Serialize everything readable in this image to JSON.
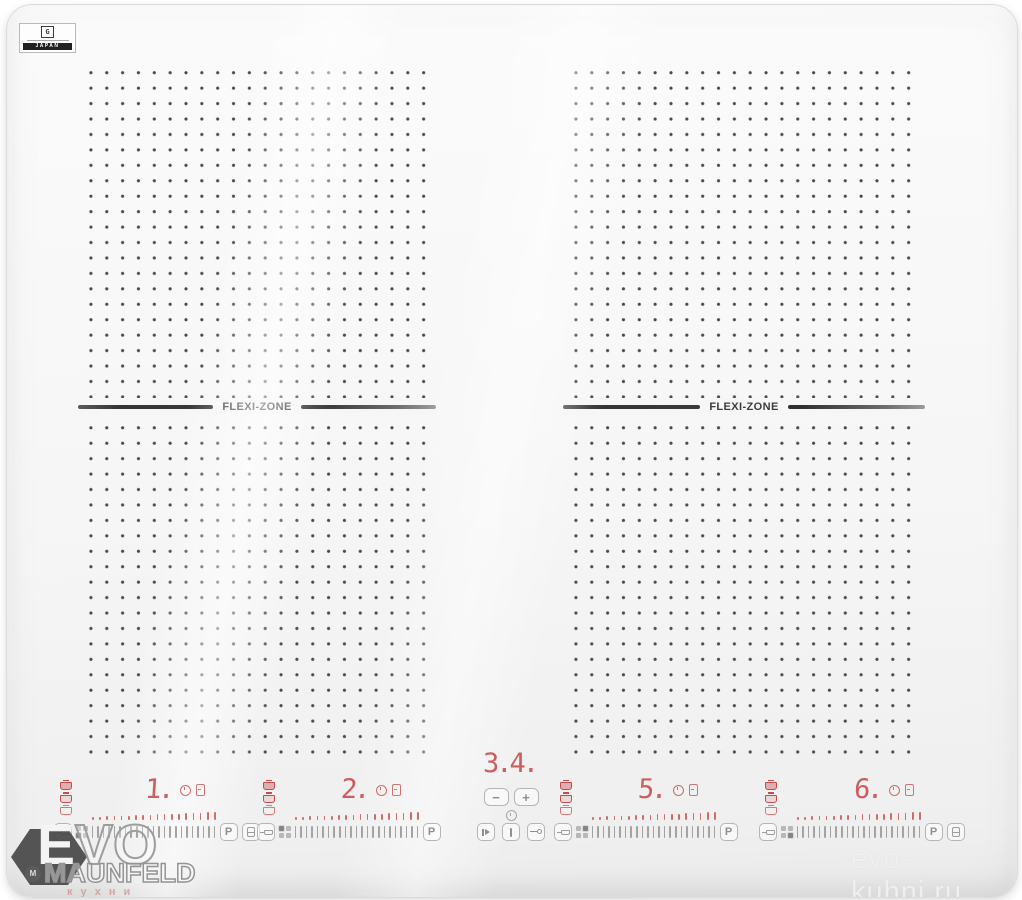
{
  "badge": {
    "logo_letter": "G",
    "country_label": "JAPAN"
  },
  "surface": {
    "flexi_label": "FLEXI-ZONE"
  },
  "controls": {
    "zones": [
      {
        "name": "zone-1",
        "digit": "1.",
        "boost": "P"
      },
      {
        "name": "zone-2",
        "digit": "2.",
        "boost": "P"
      },
      {
        "name": "zone-5",
        "digit": "5.",
        "boost": "P"
      },
      {
        "name": "zone-6",
        "digit": "6.",
        "boost": "P"
      }
    ],
    "timer": {
      "display": "3.4.",
      "minus": "−",
      "plus": "+"
    }
  },
  "watermarks": {
    "left": {
      "title_first": "E",
      "title_rest": "VO",
      "logo_letter": "M",
      "brand": "MAUNFELD",
      "subtitle": "кухни"
    },
    "right": {
      "site": "evo-kuhni.ru"
    }
  },
  "colors": {
    "display_red": "#c64b4b",
    "dot_gray": "#4a4a4a",
    "control_gray": "#a3a3a3",
    "flexi_dark": "#3c3c3c"
  }
}
